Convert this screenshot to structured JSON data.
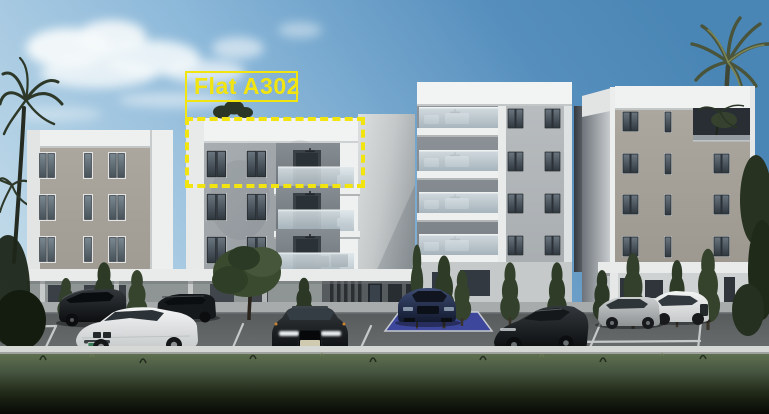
{
  "annotation": {
    "label": "Flat A302",
    "color": "#f2e40e",
    "label_box": {
      "x": 185,
      "y": 71,
      "w": 113,
      "h": 31
    },
    "dashed_box": {
      "x": 185,
      "y": 117,
      "w": 180,
      "h": 71
    },
    "connector": {
      "x": 185,
      "y": 102,
      "h": 15
    }
  },
  "scene": {
    "setting": "Exterior 3D render of a modern apartment complex with front parking lot",
    "buildings": [
      {
        "id": "left-block-a1",
        "upper_floors": 3,
        "window_columns": 3
      },
      {
        "id": "left-block-a2",
        "upper_floors": 3,
        "balconies": 3,
        "highlighted_flat": "Flat A302"
      },
      {
        "id": "center-block",
        "upper_floors": 4,
        "balconies": 4
      },
      {
        "id": "right-block",
        "upper_floors": 4,
        "roof_terrace": true
      }
    ],
    "cars": [
      "black-suv",
      "white-coupe",
      "dark-estate",
      "black-sedan",
      "blue-hatchback",
      "black-sports-coupe",
      "silver-hatchback",
      "white-suv"
    ],
    "vegetation": [
      "left-palm",
      "right-palm",
      "cypress-trees",
      "round-tree",
      "roof-shrub",
      "right-edge-trees"
    ],
    "features": [
      "accessible-blue-parking-bay",
      "white-parking-lines",
      "entrance-canopy",
      "white-kerb-wall",
      "foreground-grass-bank"
    ]
  },
  "colors": {
    "annotation_yellow": "#f2e40e",
    "sky_top": "#4a86b5",
    "sky_light": "#c9dfeb",
    "cloud_white": "#f6fafb",
    "building_white": "#f0f2f2",
    "wall_warm_grey": "#a6a29b",
    "wall_cool_grey": "#9ba1a5",
    "wall_light_grey": "#b3b8bb",
    "window_dark": "#2e353b",
    "balcony_glass": "#ccd8de",
    "asphalt_grey": "#5a5e5f",
    "parking_line": "#d9dbdb",
    "curb_white": "#d7d9d6",
    "grass_dark": "#11160c",
    "tree_green": "#31402a",
    "accessible_blue": "#3b45a0",
    "car_black": "#121517",
    "car_white": "#e9ebeb",
    "car_silver": "#b5b9ba",
    "car_navy": "#22305a"
  }
}
